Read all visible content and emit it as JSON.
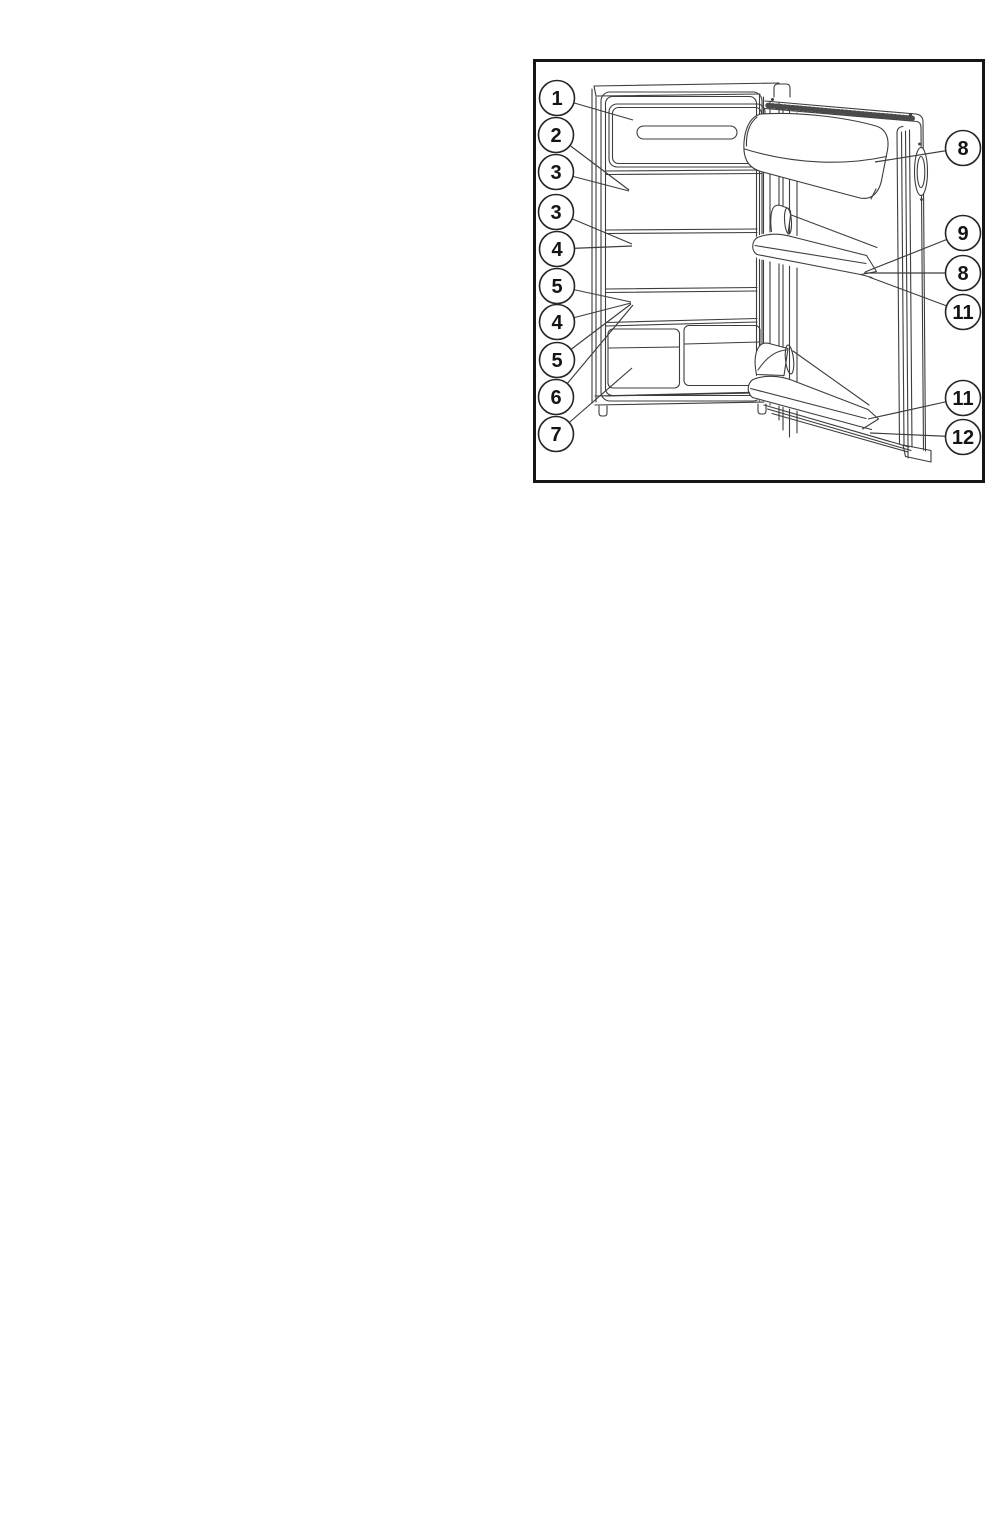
{
  "page": {
    "width": 1007,
    "height": 1533,
    "background": "#ffffff"
  },
  "figure": {
    "kind": "technical-line-illustration",
    "subject": "Refrigerator with open door - numbered parts diagram",
    "frame": {
      "x": 533,
      "y": 59,
      "width": 452,
      "height": 424
    },
    "colors": {
      "frame_border": "#161616",
      "line": "#3d3d3d",
      "background": "#ffffff"
    },
    "callouts": [
      {
        "label": "1",
        "cx": 557,
        "cy": 98,
        "tx": 633,
        "ty": 120
      },
      {
        "label": "2",
        "cx": 556,
        "cy": 135,
        "tx": 629,
        "ty": 190
      },
      {
        "label": "3",
        "cx": 556,
        "cy": 172,
        "tx": 629,
        "ty": 191
      },
      {
        "label": "3",
        "cx": 556,
        "cy": 212,
        "tx": 632,
        "ty": 244
      },
      {
        "label": "4",
        "cx": 557,
        "cy": 249,
        "tx": 632,
        "ty": 246
      },
      {
        "label": "5",
        "cx": 557,
        "cy": 286,
        "tx": 631,
        "ty": 302
      },
      {
        "label": "4",
        "cx": 557,
        "cy": 322,
        "tx": 631,
        "ty": 303
      },
      {
        "label": "5",
        "cx": 557,
        "cy": 360,
        "tx": 631,
        "ty": 304
      },
      {
        "label": "6",
        "cx": 556,
        "cy": 397,
        "tx": 633,
        "ty": 305
      },
      {
        "label": "7",
        "cx": 556,
        "cy": 434,
        "tx": 632,
        "ty": 368
      },
      {
        "label": "8",
        "cx": 963,
        "cy": 148,
        "tx": 875,
        "ty": 162
      },
      {
        "label": "9",
        "cx": 963,
        "cy": 233,
        "tx": 865,
        "ty": 272
      },
      {
        "label": "8",
        "cx": 963,
        "cy": 273,
        "tx": 864,
        "ty": 273
      },
      {
        "label": "11",
        "cx": 963,
        "cy": 312,
        "tx": 869,
        "ty": 277
      },
      {
        "label": "11",
        "cx": 963,
        "cy": 398,
        "tx": 868,
        "ty": 419
      },
      {
        "label": "12",
        "cx": 963,
        "cy": 437,
        "tx": 870,
        "ty": 433
      }
    ]
  }
}
